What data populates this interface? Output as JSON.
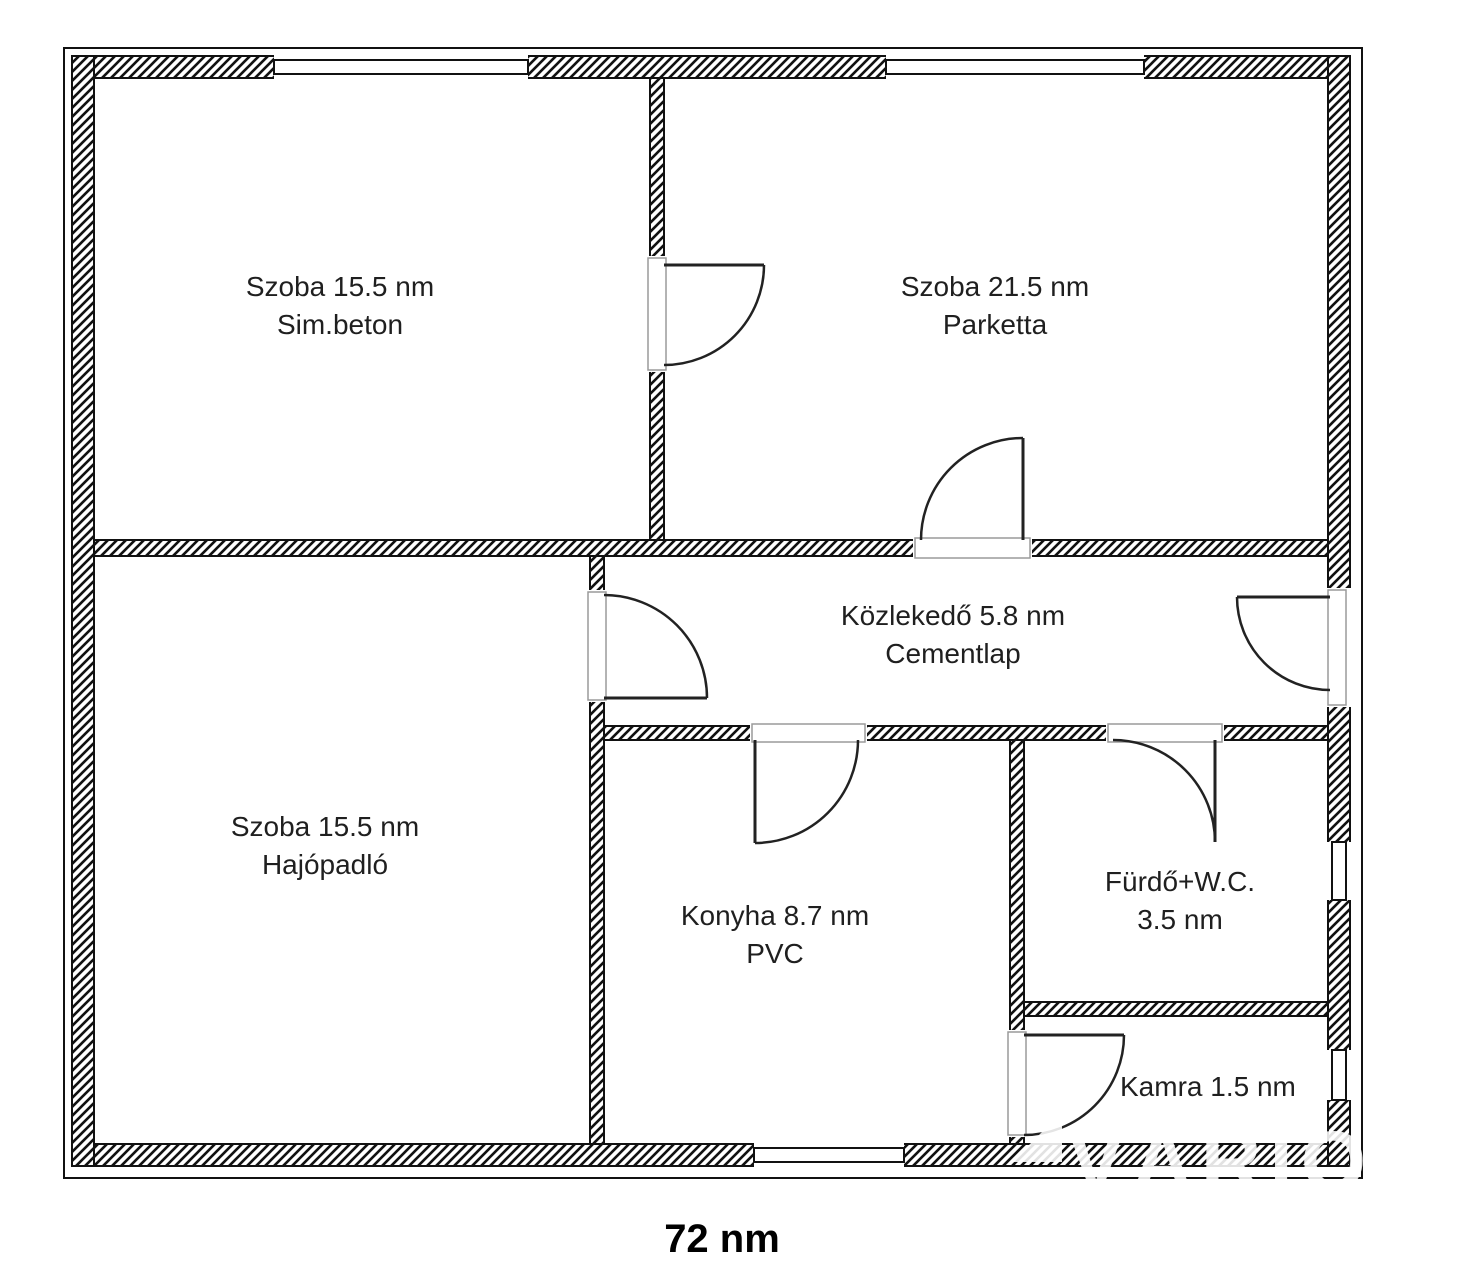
{
  "floorplan": {
    "total_area_label": "72 nm",
    "watermark_text": "VÁRIO",
    "rooms": [
      {
        "id": "szoba-topleft",
        "line1": "Szoba 15.5 nm",
        "line2": "Sim.beton"
      },
      {
        "id": "szoba-topright",
        "line1": "Szoba 21.5 nm",
        "line2": "Parketta"
      },
      {
        "id": "kozlekedo",
        "line1": "Közlekedő 5.8 nm",
        "line2": "Cementlap"
      },
      {
        "id": "szoba-bottomleft",
        "line1": "Szoba 15.5 nm",
        "line2": "Hajópadló"
      },
      {
        "id": "konyha",
        "line1": "Konyha 8.7 nm",
        "line2": "PVC"
      },
      {
        "id": "furdo-wc",
        "line1": "Fürdő+W.C.",
        "line2": "3.5 nm"
      },
      {
        "id": "kamra",
        "line1": "Kamra 1.5 nm",
        "line2": ""
      }
    ]
  }
}
